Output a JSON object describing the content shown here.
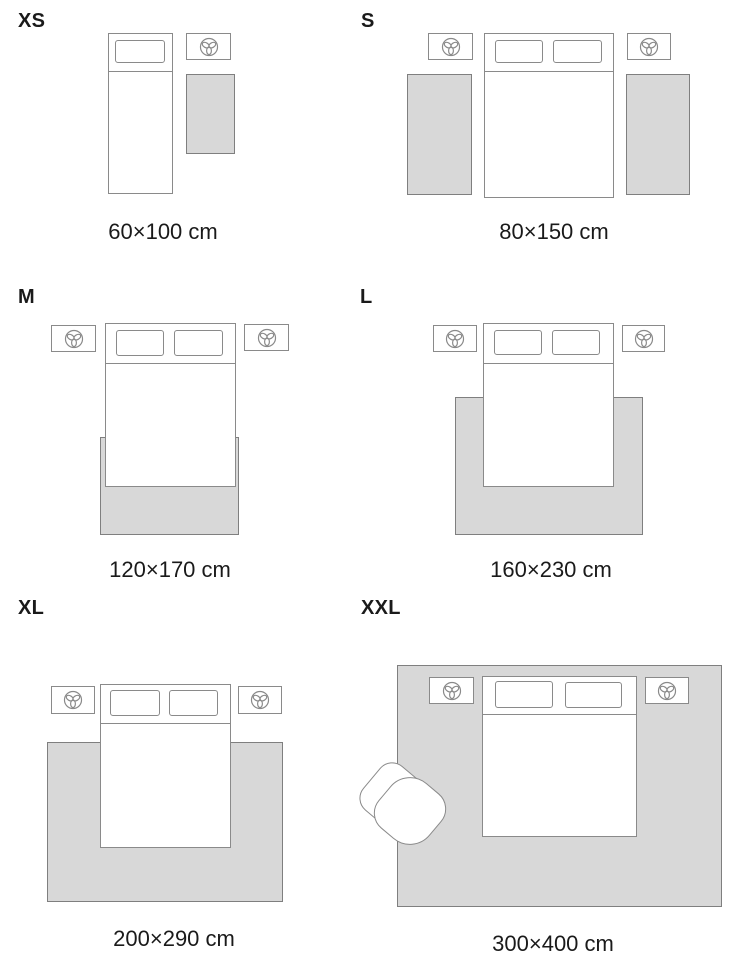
{
  "title": "Rug size guide",
  "colors": {
    "background": "#ffffff",
    "text": "#1a1a1a",
    "outline": "#8a8a8a",
    "rug_fill": "#d8d8d8",
    "rug_border": "#7f7f7f"
  },
  "icons": {
    "nightstand_icon": "plant-icon"
  },
  "panels": [
    {
      "id": "xs",
      "label": "XS",
      "size": "60×100 cm"
    },
    {
      "id": "s",
      "label": "S",
      "size": "80×150 cm"
    },
    {
      "id": "m",
      "label": "M",
      "size": "120×170 cm"
    },
    {
      "id": "l",
      "label": "L",
      "size": "160×230 cm"
    },
    {
      "id": "xl",
      "label": "XL",
      "size": "200×290 cm"
    },
    {
      "id": "xxl",
      "label": "XXL",
      "size": "300×400 cm"
    }
  ]
}
